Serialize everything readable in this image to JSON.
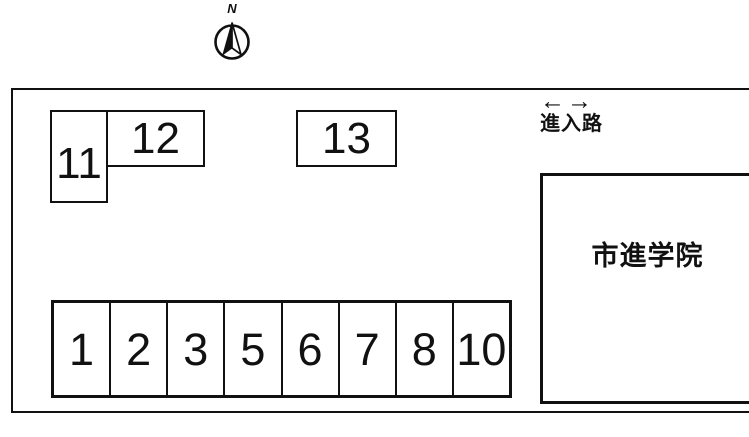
{
  "compass": {
    "label": "N"
  },
  "entrance": {
    "arrow_left": "←",
    "arrow_right": "→",
    "label": "進入路"
  },
  "building": {
    "label": "市進学院"
  },
  "parking": {
    "top_row": [
      "11",
      "12",
      "13"
    ],
    "bottom_row": [
      "1",
      "2",
      "3",
      "5",
      "6",
      "7",
      "8",
      "10"
    ]
  },
  "colors": {
    "line": "#111111",
    "background": "#ffffff"
  }
}
